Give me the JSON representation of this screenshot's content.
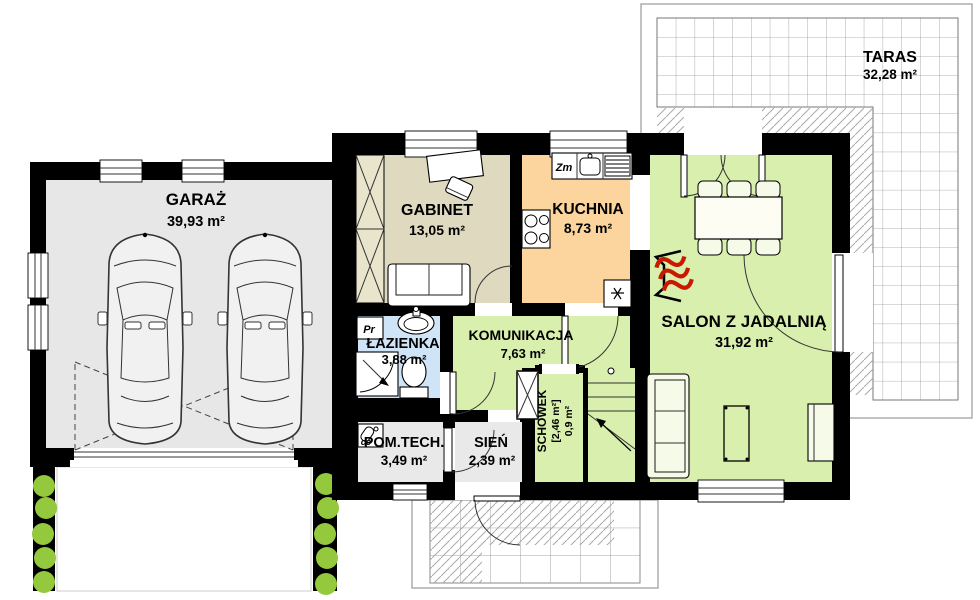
{
  "rooms": {
    "garage": {
      "label": "GARAŻ",
      "area": "39,93 m²"
    },
    "office": {
      "label": "GABINET",
      "area": "13,05 m²"
    },
    "kitchen": {
      "label": "KUCHNIA",
      "area": "8,73 m²"
    },
    "living": {
      "label": "SALON Z JADALNIĄ",
      "area": "31,92 m²"
    },
    "bathroom": {
      "label": "ŁAZIENKA",
      "area": "3,88 m²"
    },
    "hall": {
      "label": "KOMUNIKACJA",
      "area": "7,63 m²"
    },
    "storage": {
      "label": "SCHOWEK",
      "area_bracket": "[2,46 m²]",
      "area": "0,9 m²"
    },
    "technical": {
      "label": "POM.TECH.",
      "area": "3,49 m²"
    },
    "vestibule": {
      "label": "SIEŃ",
      "area": "2,39 m²"
    },
    "terrace": {
      "label": "TARAS",
      "area": "32,28 m²"
    }
  },
  "markers": {
    "kitchen_sink": "Zm",
    "washing_machine": "Pr",
    "boiler": "co"
  },
  "colors": {
    "wall": "#000000",
    "garage_floor": "#e7e7e7",
    "office_floor": "#ded9bf",
    "kitchen_floor": "#fbd49e",
    "living_floor": "#d9efad",
    "bathroom_floor": "#cfe4f6",
    "hall_floor": "#d9efad",
    "utility_floor": "#e9e9e9",
    "wardrobe": "#e9e4cc",
    "shrub": "#94c83d",
    "fireplace": "#c81800"
  }
}
